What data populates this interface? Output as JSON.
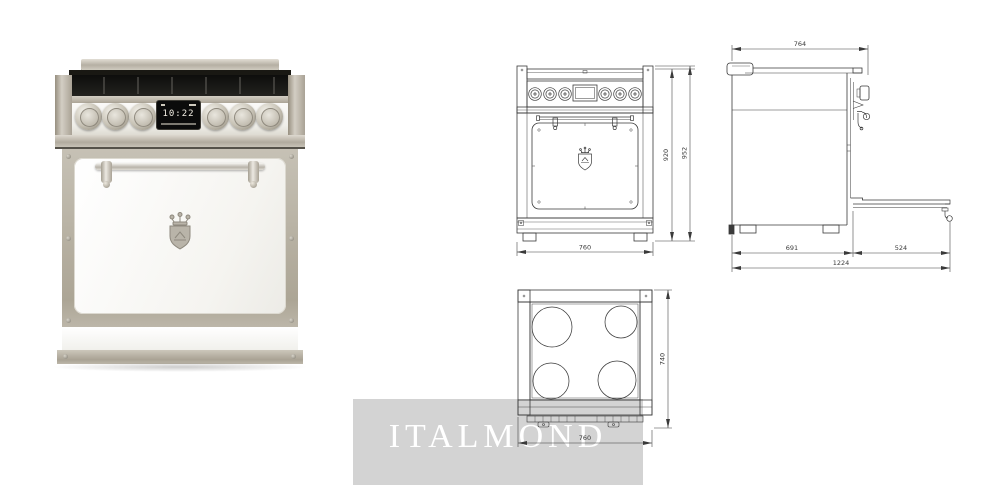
{
  "watermark": {
    "text": "ITALMOND"
  },
  "photo": {
    "display": {
      "time": "10:22"
    }
  },
  "drawings": {
    "front": {
      "dims": {
        "inner_height": "920",
        "total_height": "952",
        "width": "760"
      }
    },
    "side": {
      "dims": {
        "top_depth": "764",
        "body_depth": "691",
        "open_door_depth": "524",
        "total_depth": "1224"
      }
    },
    "top": {
      "dims": {
        "depth": "740",
        "width": "760"
      }
    }
  },
  "colors": {
    "trim": "#b7b1a5",
    "door": "#fbfbfa",
    "cooktop": "#171717",
    "drawing_line": "#3a3a3a",
    "watermark_band": "#d3d3d3",
    "watermark_text": "#ffffff"
  }
}
